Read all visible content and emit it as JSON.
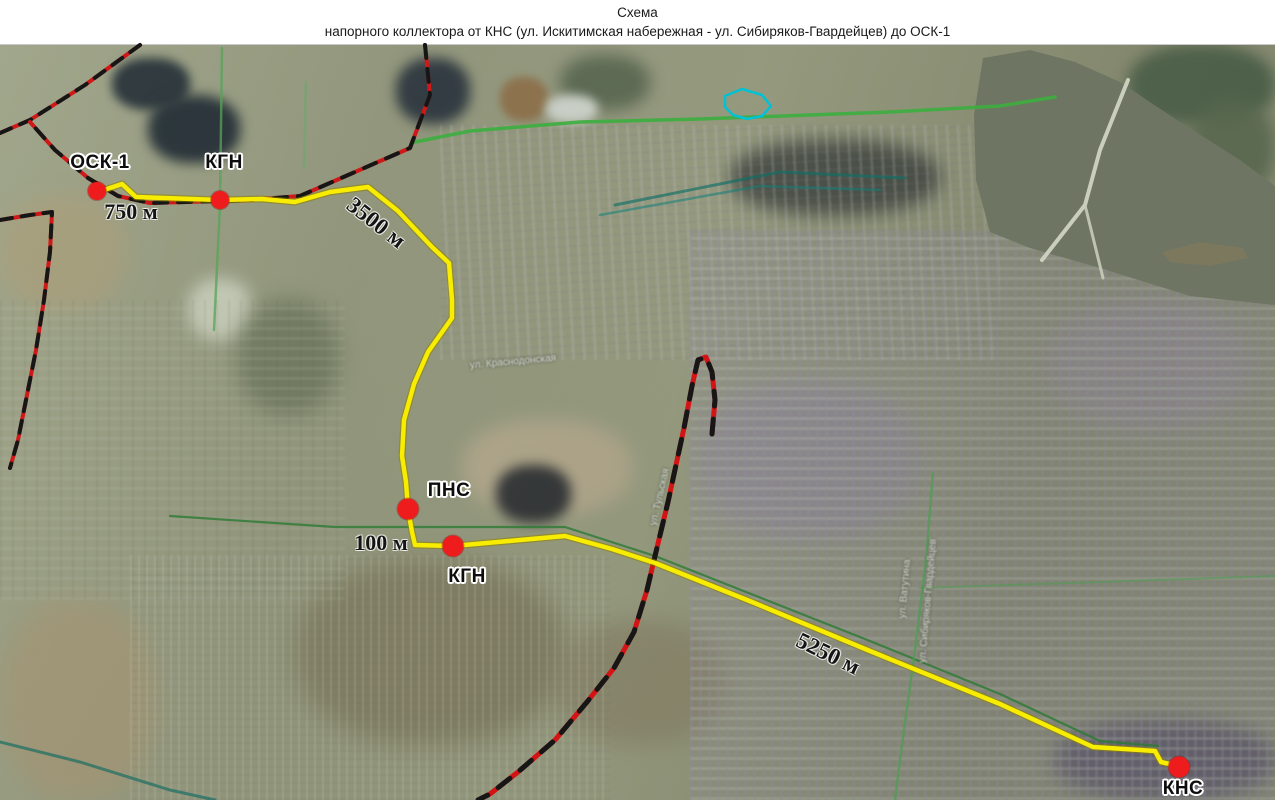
{
  "title": {
    "line1": "Схема",
    "line2": "напорного коллектора от КНС (ул. Искитимская набережная - ул. Сибиряков-Гвардейцев) до ОСК-1"
  },
  "map": {
    "legend_colors": {
      "pressure_collector_route": "#f8ec00",
      "station_dot": "#ee1c1c",
      "railway": "#d41414",
      "railway_dash": "#161616",
      "local_road": "#3cae3f",
      "river_water": "#6e7562"
    },
    "stations": [
      {
        "label": "ОСК-1",
        "dot": [
          97,
          191
        ],
        "label_pos": [
          100,
          163
        ],
        "dot_size": 18
      },
      {
        "label": "КГН",
        "dot": [
          220,
          200
        ],
        "label_pos": [
          224,
          163
        ],
        "dot_size": 18
      },
      {
        "label": "ПНС",
        "dot": [
          408,
          509
        ],
        "label_pos": [
          449,
          491
        ],
        "dot_size": 21
      },
      {
        "label": "КГН",
        "dot": [
          453,
          546
        ],
        "label_pos": [
          467,
          577
        ],
        "dot_size": 21
      },
      {
        "label": "КНС",
        "dot": [
          1179,
          767
        ],
        "label_pos": [
          1183,
          789
        ],
        "dot_size": 21
      }
    ],
    "distance_labels": [
      {
        "text": "750 м",
        "pos": [
          131,
          212
        ],
        "rotate": 0,
        "size": 22
      },
      {
        "text": "3500 м",
        "pos": [
          376,
          223
        ],
        "rotate": 38,
        "size": 23
      },
      {
        "text": "100 м",
        "pos": [
          381,
          543
        ],
        "rotate": 0,
        "size": 22
      },
      {
        "text": "5250 м",
        "pos": [
          828,
          654
        ],
        "rotate": 26,
        "size": 23
      }
    ],
    "street_labels": [
      {
        "text": "ул. Краснодонская",
        "pos": [
          513,
          362
        ],
        "rotate": -5
      },
      {
        "text": "ул. Тульская",
        "pos": [
          660,
          497
        ],
        "rotate": -77
      },
      {
        "text": "ул. Ватутина",
        "pos": [
          905,
          589
        ],
        "rotate": -85
      },
      {
        "text": "ул. Сибиряков-Гвардейцев",
        "pos": [
          928,
          601
        ],
        "rotate": -85
      }
    ],
    "lines": [
      {
        "name": "river",
        "fill": "#6e7562",
        "closed": true,
        "points": [
          [
            983,
            58
          ],
          [
            1030,
            50
          ],
          [
            1075,
            62
          ],
          [
            1120,
            82
          ],
          [
            1180,
            122
          ],
          [
            1240,
            160
          ],
          [
            1275,
            186
          ],
          [
            1275,
            305
          ],
          [
            1190,
            296
          ],
          [
            1100,
            268
          ],
          [
            1030,
            248
          ],
          [
            990,
            232
          ],
          [
            976,
            180
          ],
          [
            974,
            115
          ]
        ]
      },
      {
        "name": "river-island",
        "fill": "#7b785e",
        "closed": true,
        "points": [
          [
            1162,
            252
          ],
          [
            1200,
            242
          ],
          [
            1243,
            248
          ],
          [
            1248,
            258
          ],
          [
            1210,
            266
          ],
          [
            1170,
            262
          ]
        ]
      },
      {
        "name": "bridge-road",
        "color": "#cfd3c2",
        "width": 4,
        "opacity": 0.95,
        "points": [
          [
            1128,
            80
          ],
          [
            1100,
            150
          ],
          [
            1085,
            205
          ],
          [
            1042,
            260
          ]
        ]
      },
      {
        "name": "bridge-road-branch",
        "color": "#c8ccba",
        "width": 3,
        "opacity": 0.9,
        "points": [
          [
            1085,
            205
          ],
          [
            1103,
            278
          ]
        ]
      },
      {
        "name": "green-road-main",
        "color": "#3cae3f",
        "width": 3.5,
        "opacity": 0.9,
        "points": [
          [
            415,
            142
          ],
          [
            470,
            131
          ],
          [
            580,
            122
          ],
          [
            700,
            119
          ],
          [
            890,
            112
          ],
          [
            1000,
            106
          ],
          [
            1055,
            97
          ]
        ]
      },
      {
        "name": "green-road-kgn-vertical",
        "color": "#57a35a",
        "width": 2.5,
        "opacity": 0.75,
        "points": [
          [
            222,
            48
          ],
          [
            220,
            205
          ],
          [
            214,
            330
          ]
        ]
      },
      {
        "name": "green-road-upper-left",
        "color": "#6aa86d",
        "width": 2.5,
        "opacity": 0.6,
        "points": [
          [
            306,
            82
          ],
          [
            304,
            168
          ]
        ]
      },
      {
        "name": "green-road-along-route",
        "color": "#2c7a33",
        "width": 2.2,
        "opacity": 0.8,
        "points": [
          [
            170,
            516
          ],
          [
            335,
            527
          ],
          [
            565,
            527
          ],
          [
            655,
            556
          ],
          [
            870,
            641
          ],
          [
            1000,
            694
          ],
          [
            1100,
            741
          ],
          [
            1158,
            746
          ]
        ]
      },
      {
        "name": "green-road-right-vertical",
        "color": "#4d9c52",
        "width": 2.5,
        "opacity": 0.7,
        "points": [
          [
            933,
            473
          ],
          [
            926,
            560
          ],
          [
            915,
            650
          ],
          [
            900,
            760
          ],
          [
            895,
            800
          ]
        ]
      },
      {
        "name": "green-road-right-horizontal",
        "color": "#4d9c52",
        "width": 2,
        "opacity": 0.55,
        "points": [
          [
            920,
            588
          ],
          [
            1100,
            582
          ],
          [
            1275,
            576
          ]
        ]
      },
      {
        "name": "teal-rail-yard-1",
        "color": "#0f6f66",
        "width": 3,
        "opacity": 0.65,
        "points": [
          [
            615,
            205
          ],
          [
            780,
            172
          ],
          [
            905,
            178
          ]
        ]
      },
      {
        "name": "teal-rail-yard-2",
        "color": "#13807a",
        "width": 2.5,
        "opacity": 0.55,
        "points": [
          [
            600,
            215
          ],
          [
            760,
            186
          ],
          [
            880,
            190
          ]
        ]
      },
      {
        "name": "teal-road-bottom-left",
        "color": "#1b6e63",
        "width": 3,
        "opacity": 0.7,
        "points": [
          [
            0,
            742
          ],
          [
            80,
            762
          ],
          [
            170,
            790
          ],
          [
            215,
            800
          ]
        ]
      },
      {
        "name": "road-top-left-diagonal",
        "color": "#cf1818",
        "width": 4,
        "overlay": {
          "color": "#161616",
          "dash": "12 10"
        },
        "points": [
          [
            140,
            45
          ],
          [
            85,
            85
          ],
          [
            30,
            120
          ],
          [
            0,
            133
          ]
        ]
      },
      {
        "name": "road-left-edge",
        "color": "#cf1818",
        "width": 4,
        "overlay": {
          "color": "#161616",
          "dash": "12 10"
        },
        "points": [
          [
            0,
            220
          ],
          [
            30,
            215
          ],
          [
            52,
            212
          ],
          [
            50,
            252
          ],
          [
            44,
            300
          ],
          [
            36,
            350
          ],
          [
            27,
            395
          ],
          [
            18,
            440
          ],
          [
            10,
            468
          ]
        ]
      },
      {
        "name": "road-main-west",
        "color": "#cf1818",
        "width": 4,
        "overlay": {
          "color": "#161616",
          "dash": "13 11"
        },
        "points": [
          [
            425,
            45
          ],
          [
            430,
            95
          ],
          [
            410,
            148
          ],
          [
            355,
            172
          ],
          [
            300,
            196
          ],
          [
            250,
            200
          ],
          [
            220,
            201
          ],
          [
            150,
            203
          ],
          [
            118,
            196
          ],
          [
            88,
            178
          ],
          [
            55,
            150
          ],
          [
            30,
            122
          ]
        ]
      },
      {
        "name": "railway",
        "color": "#d41414",
        "width": 5,
        "overlay": {
          "color": "#161616",
          "dash": "15 13"
        },
        "points": [
          [
            712,
            434
          ],
          [
            715,
            400
          ],
          [
            712,
            372
          ],
          [
            706,
            357
          ],
          [
            698,
            360
          ],
          [
            692,
            386
          ],
          [
            684,
            428
          ],
          [
            668,
            502
          ],
          [
            655,
            556
          ],
          [
            647,
            590
          ],
          [
            634,
            632
          ],
          [
            614,
            668
          ],
          [
            587,
            702
          ],
          [
            555,
            740
          ],
          [
            518,
            772
          ],
          [
            490,
            794
          ],
          [
            478,
            800
          ]
        ]
      },
      {
        "name": "pressure-collector-route",
        "color": "#f8ec00",
        "width": 4.5,
        "edge": "#8d8200",
        "points": [
          [
            104,
            190
          ],
          [
            122,
            184
          ],
          [
            136,
            197
          ],
          [
            220,
            200
          ],
          [
            262,
            199
          ],
          [
            295,
            202
          ],
          [
            330,
            192
          ],
          [
            368,
            187
          ],
          [
            398,
            211
          ],
          [
            432,
            247
          ],
          [
            449,
            263
          ],
          [
            452,
            300
          ],
          [
            452,
            318
          ],
          [
            428,
            352
          ],
          [
            414,
            384
          ],
          [
            404,
            420
          ],
          [
            402,
            456
          ],
          [
            406,
            482
          ],
          [
            408,
            509
          ],
          [
            412,
            532
          ],
          [
            415,
            545
          ],
          [
            453,
            546
          ],
          [
            520,
            540
          ],
          [
            565,
            536
          ],
          [
            612,
            549
          ],
          [
            655,
            563
          ],
          [
            752,
            602
          ],
          [
            870,
            651
          ],
          [
            1000,
            704
          ],
          [
            1093,
            747
          ],
          [
            1155,
            751
          ],
          [
            1161,
            762
          ],
          [
            1178,
            766
          ]
        ]
      },
      {
        "name": "cyan-boundary-polygon",
        "color": "#00c2d4",
        "width": 2.5,
        "closed": true,
        "points": [
          [
            725,
            96
          ],
          [
            742,
            89
          ],
          [
            762,
            95
          ],
          [
            771,
            106
          ],
          [
            762,
            116
          ],
          [
            747,
            119
          ],
          [
            733,
            115
          ],
          [
            725,
            107
          ]
        ]
      }
    ]
  }
}
